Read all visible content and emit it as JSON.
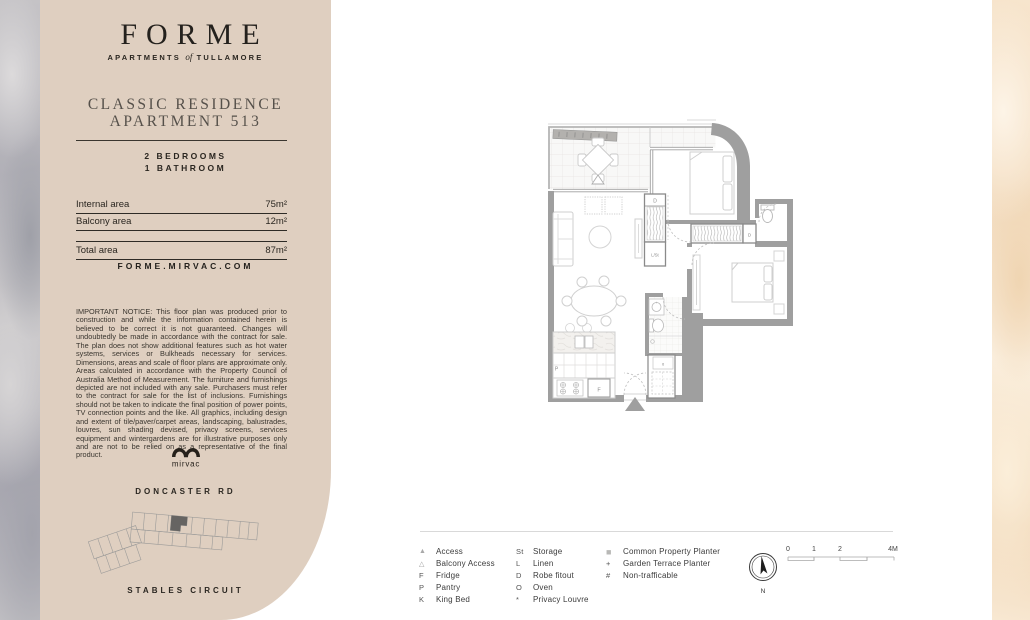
{
  "brand": {
    "logo": "FORME",
    "tagline_prefix": "APARTMENTS",
    "tagline_of": "of",
    "tagline_suffix": "TULLAMORE"
  },
  "residence": {
    "title_line1": "CLASSIC RESIDENCE",
    "title_line2": "APARTMENT 513",
    "bedrooms": "2 BEDROOMS",
    "bathrooms": "1 BATHROOM"
  },
  "areas": {
    "internal": {
      "label": "Internal area",
      "value": "75m²"
    },
    "balcony": {
      "label": "Balcony area",
      "value": "12m²"
    },
    "total": {
      "label": "Total area",
      "value": "87m²"
    }
  },
  "website": "FORME.MIRVAC.COM",
  "notice": "IMPORTANT NOTICE: This floor plan was produced prior to construction and while the information contained herein is believed to be correct it is not guaranteed. Changes will undoubtedly be made in accordance with the contract for sale. The plan does not show additional features such as hot water systems, services or Bulkheads necessary for services. Dimensions, areas and scale of floor plans are approximate only. Areas calculated in accordance with the Property Council of Australia Method of Measurement. The furniture and furnishings depicted are not included with any sale. Purchasers must refer to the contract for sale for the list of inclusions.  Furnishings should not be taken to indicate the final position of power points, TV connection points and the like. All graphics, including design and extent of tile/paver/carpet areas, landscaping, balustrades, louvres, sun shading devised, privacy screens, services equipment and wintergardens are for illustrative purposes only and are not to be relied on as a representative of the final product.",
  "developer": {
    "name": "mirvac"
  },
  "location": {
    "road_top": "DONCASTER RD",
    "road_bottom": "STABLES CIRCUIT"
  },
  "floorplan": {
    "labels": {
      "robe_1": "D",
      "linen_store": "L/St",
      "robe_2": "D",
      "pantry": "P",
      "fridge": "F",
      "appliance": "o"
    }
  },
  "legend": {
    "column1": [
      {
        "icon": "▲",
        "label": "Access"
      },
      {
        "icon": "△",
        "label": "Balcony Access"
      },
      {
        "icon": "F",
        "label": "Fridge"
      },
      {
        "icon": "P",
        "label": "Pantry"
      },
      {
        "icon": "K",
        "label": "King Bed"
      }
    ],
    "column2": [
      {
        "icon": "St",
        "label": "Storage"
      },
      {
        "icon": "L",
        "label": "Linen"
      },
      {
        "icon": "D",
        "label": "Robe fitout"
      },
      {
        "icon": "O",
        "label": "Oven"
      },
      {
        "icon": "*",
        "label": "Privacy Louvre"
      }
    ],
    "column3": [
      {
        "icon": "■",
        "label": "Common Property Planter"
      },
      {
        "icon": "+",
        "label": "Garden Terrace Planter"
      },
      {
        "icon": "#",
        "label": "Non-trafficable"
      }
    ]
  },
  "scalebar": {
    "labels": [
      "0",
      "1",
      "2",
      "4M"
    ]
  },
  "compass": {
    "north": "N"
  },
  "colors": {
    "panel": "#dfcfc0",
    "wall": "#9f9f9f",
    "text_dark": "#2a2620"
  }
}
